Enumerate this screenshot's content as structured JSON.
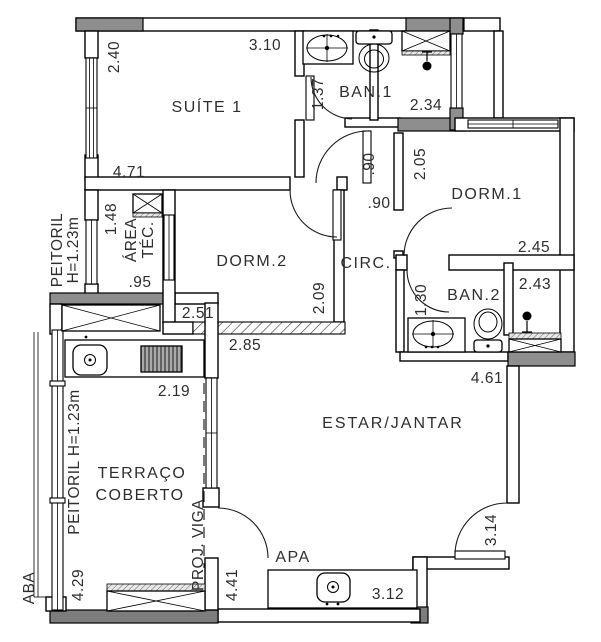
{
  "plan": {
    "rooms": {
      "suite1": "SUÍTE 1",
      "ban1": "BAN.1",
      "dorm1": "DORM.1",
      "dorm2": "DORM.2",
      "circ": "CIRC.",
      "ban2": "BAN.2",
      "estar": "ESTAR/JANTAR",
      "terraco1": "TERRAÇO",
      "terraco2": "COBERTO",
      "apa": "APA",
      "area1": "ÁREA",
      "area2": "TÉC."
    },
    "dimensions": {
      "d240": "2.40",
      "d310": "3.10",
      "d471": "4.71",
      "d137": "1.37",
      "d234": "2.34",
      "d205": "2.05",
      "d245": "2.45",
      "d090a": ".90",
      "d090b": ".90",
      "d148": "1.48",
      "d095": ".95",
      "d251": "2.51",
      "d209": "2.09",
      "d285": "2.85",
      "d243": "2.43",
      "d130": "1.30",
      "d461": "4.61",
      "d219": "2.19",
      "d429": "4.29",
      "d441": "4.41",
      "d312": "3.12",
      "d314": "3.14"
    },
    "annotations": {
      "peitoril1a": "PEITORIL",
      "peitoril1b": "H=1.23m",
      "peitoril2": "PEITORIL  H=1.23m",
      "projviga": "PROJ.  VIGA",
      "aba": "ABA"
    }
  }
}
